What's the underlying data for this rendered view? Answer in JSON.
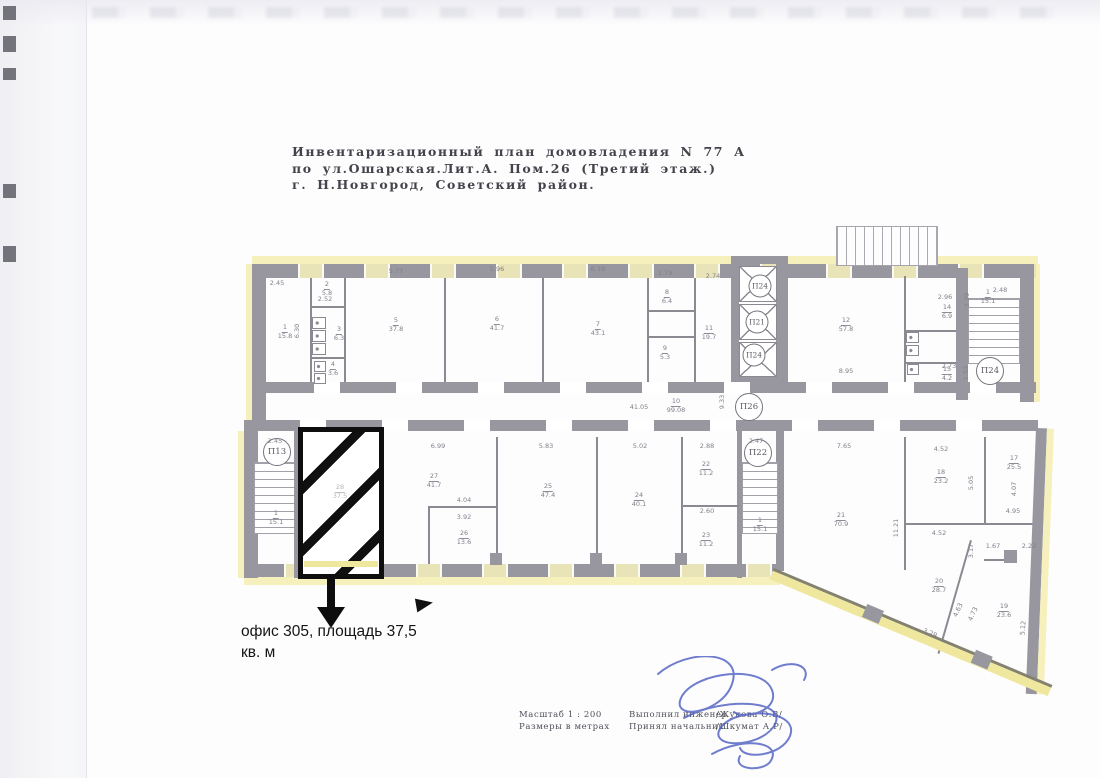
{
  "document": {
    "title_lines": [
      "Инвентаризационный план домовладения N 77 А",
      "по ул.Ошарская.Лит.А. Пом.26 (Третий этаж.)",
      "г. Н.Новгород, Советский район."
    ],
    "callout": {
      "line1": "офис 305, площадь 37,5",
      "line2": "кв. м"
    },
    "footer": {
      "scale_line1": "Масштаб 1 : 200",
      "scale_line2": "Размеры в метрах",
      "made_by": "Выполнил инженер",
      "made_by_name": "/Жукова О.В/",
      "accepted_by": "Принял начальник",
      "accepted_by_name": "/Шкумат А.Р/"
    }
  },
  "colors": {
    "highlight_yellow": "#f6f0bd",
    "wall_gray": "#98979f",
    "office_outline": "#0e0e0e",
    "signature_blue": "#4d5ec2"
  },
  "plan": {
    "labels": [
      {
        "c": "П13",
        "x": 277,
        "y": 452
      },
      {
        "c": "П24",
        "x": 760,
        "y": 286,
        "s": 1
      },
      {
        "c": "П21",
        "x": 757,
        "y": 322,
        "s": 1
      },
      {
        "c": "П24",
        "x": 754,
        "y": 355,
        "s": 1
      },
      {
        "c": "П26",
        "x": 749,
        "y": 407
      },
      {
        "c": "П22",
        "x": 758,
        "y": 453
      },
      {
        "c": "П24",
        "x": 990,
        "y": 371
      },
      {
        "n": "1",
        "a": "15.8",
        "x": 285,
        "y": 332
      },
      {
        "n": "2",
        "a": "5.8",
        "x": 327,
        "y": 289
      },
      {
        "n": "3",
        "a": "6.3",
        "x": 339,
        "y": 334
      },
      {
        "n": "4",
        "a": "3.6",
        "x": 333,
        "y": 369
      },
      {
        "n": "5",
        "a": "37.8",
        "x": 396,
        "y": 325
      },
      {
        "n": "6",
        "a": "41.7",
        "x": 497,
        "y": 324
      },
      {
        "n": "7",
        "a": "43.1",
        "x": 598,
        "y": 329
      },
      {
        "n": "8",
        "a": "6.4",
        "x": 667,
        "y": 297
      },
      {
        "n": "9",
        "a": "5.3",
        "x": 665,
        "y": 353
      },
      {
        "n": "11",
        "a": "19.7",
        "x": 709,
        "y": 333
      },
      {
        "n": "12",
        "a": "57.8",
        "x": 846,
        "y": 325
      },
      {
        "n": "14",
        "a": "6.9",
        "x": 947,
        "y": 312
      },
      {
        "n": "15",
        "a": "4.2",
        "x": 947,
        "y": 374
      },
      {
        "n": "1",
        "a": "15.1",
        "x": 988,
        "y": 297
      },
      {
        "n": "10",
        "a": "99.08",
        "x": 676,
        "y": 406
      },
      {
        "n": "1",
        "a": "15.1",
        "x": 276,
        "y": 518
      },
      {
        "n": "28",
        "a": "37.5",
        "x": 340,
        "y": 492,
        "cls": "faint"
      },
      {
        "n": "27",
        "a": "41.7",
        "x": 434,
        "y": 481
      },
      {
        "n": "26",
        "a": "13.6",
        "x": 464,
        "y": 538
      },
      {
        "n": "25",
        "a": "47.4",
        "x": 548,
        "y": 491
      },
      {
        "n": "24",
        "a": "40.1",
        "x": 639,
        "y": 500
      },
      {
        "n": "22",
        "a": "11.2",
        "x": 706,
        "y": 469
      },
      {
        "n": "23",
        "a": "11.2",
        "x": 706,
        "y": 540
      },
      {
        "n": "1",
        "a": "15.1",
        "x": 760,
        "y": 525
      },
      {
        "n": "21",
        "a": "70.9",
        "x": 841,
        "y": 520
      },
      {
        "n": "18",
        "a": "23.2",
        "x": 941,
        "y": 477
      },
      {
        "n": "17",
        "a": "25.5",
        "x": 1014,
        "y": 463
      },
      {
        "n": "20",
        "a": "28.7",
        "x": 939,
        "y": 586
      },
      {
        "n": "19",
        "a": "23.6",
        "x": 1004,
        "y": 611
      },
      {
        "t": "2.45",
        "x": 277,
        "y": 283
      },
      {
        "t": "2.52",
        "x": 325,
        "y": 299
      },
      {
        "t": "5.77",
        "x": 396,
        "y": 271
      },
      {
        "t": "5.96",
        "x": 497,
        "y": 269
      },
      {
        "t": "6.19",
        "x": 598,
        "y": 269
      },
      {
        "t": "1.79",
        "x": 665,
        "y": 273
      },
      {
        "t": "2.74",
        "x": 713,
        "y": 276
      },
      {
        "t": "6.30",
        "x": 297,
        "y": 331,
        "r": -90
      },
      {
        "t": "8.95",
        "x": 846,
        "y": 371
      },
      {
        "t": "2.96",
        "x": 945,
        "y": 297
      },
      {
        "t": "2.73",
        "x": 949,
        "y": 366
      },
      {
        "t": "2.48",
        "x": 1000,
        "y": 290
      },
      {
        "t": "2.39",
        "x": 967,
        "y": 300,
        "r": -90
      },
      {
        "t": "1.53",
        "x": 966,
        "y": 373,
        "r": -90
      },
      {
        "t": "41.05",
        "x": 639,
        "y": 407
      },
      {
        "t": "9.33",
        "x": 722,
        "y": 402,
        "r": -90
      },
      {
        "t": "2.45",
        "x": 275,
        "y": 441
      },
      {
        "t": "2.47",
        "x": 756,
        "y": 441
      },
      {
        "t": "6.99",
        "x": 438,
        "y": 446
      },
      {
        "t": "5.83",
        "x": 546,
        "y": 446
      },
      {
        "t": "5.02",
        "x": 640,
        "y": 446
      },
      {
        "t": "2.88",
        "x": 707,
        "y": 446
      },
      {
        "t": "4.04",
        "x": 464,
        "y": 500
      },
      {
        "t": "3.92",
        "x": 464,
        "y": 517
      },
      {
        "t": "2.60",
        "x": 707,
        "y": 511
      },
      {
        "t": "7.65",
        "x": 844,
        "y": 446
      },
      {
        "t": "4.52",
        "x": 941,
        "y": 449
      },
      {
        "t": "4.52",
        "x": 939,
        "y": 533
      },
      {
        "t": "5.05",
        "x": 971,
        "y": 483,
        "r": -90
      },
      {
        "t": "4.07",
        "x": 1014,
        "y": 489,
        "r": -90
      },
      {
        "t": "4.95",
        "x": 1013,
        "y": 511
      },
      {
        "t": "1.67",
        "x": 993,
        "y": 546
      },
      {
        "t": "2.22",
        "x": 1029,
        "y": 546
      },
      {
        "t": "3.17",
        "x": 971,
        "y": 551,
        "r": -90
      },
      {
        "t": "11.21",
        "x": 896,
        "y": 528,
        "r": -90
      },
      {
        "t": "3.29",
        "x": 930,
        "y": 633,
        "r": 23
      },
      {
        "t": "4.63",
        "x": 958,
        "y": 610,
        "r": -65
      },
      {
        "t": "4.73",
        "x": 973,
        "y": 614,
        "r": -65
      },
      {
        "t": "5.12",
        "x": 1023,
        "y": 628,
        "r": -85
      }
    ]
  }
}
